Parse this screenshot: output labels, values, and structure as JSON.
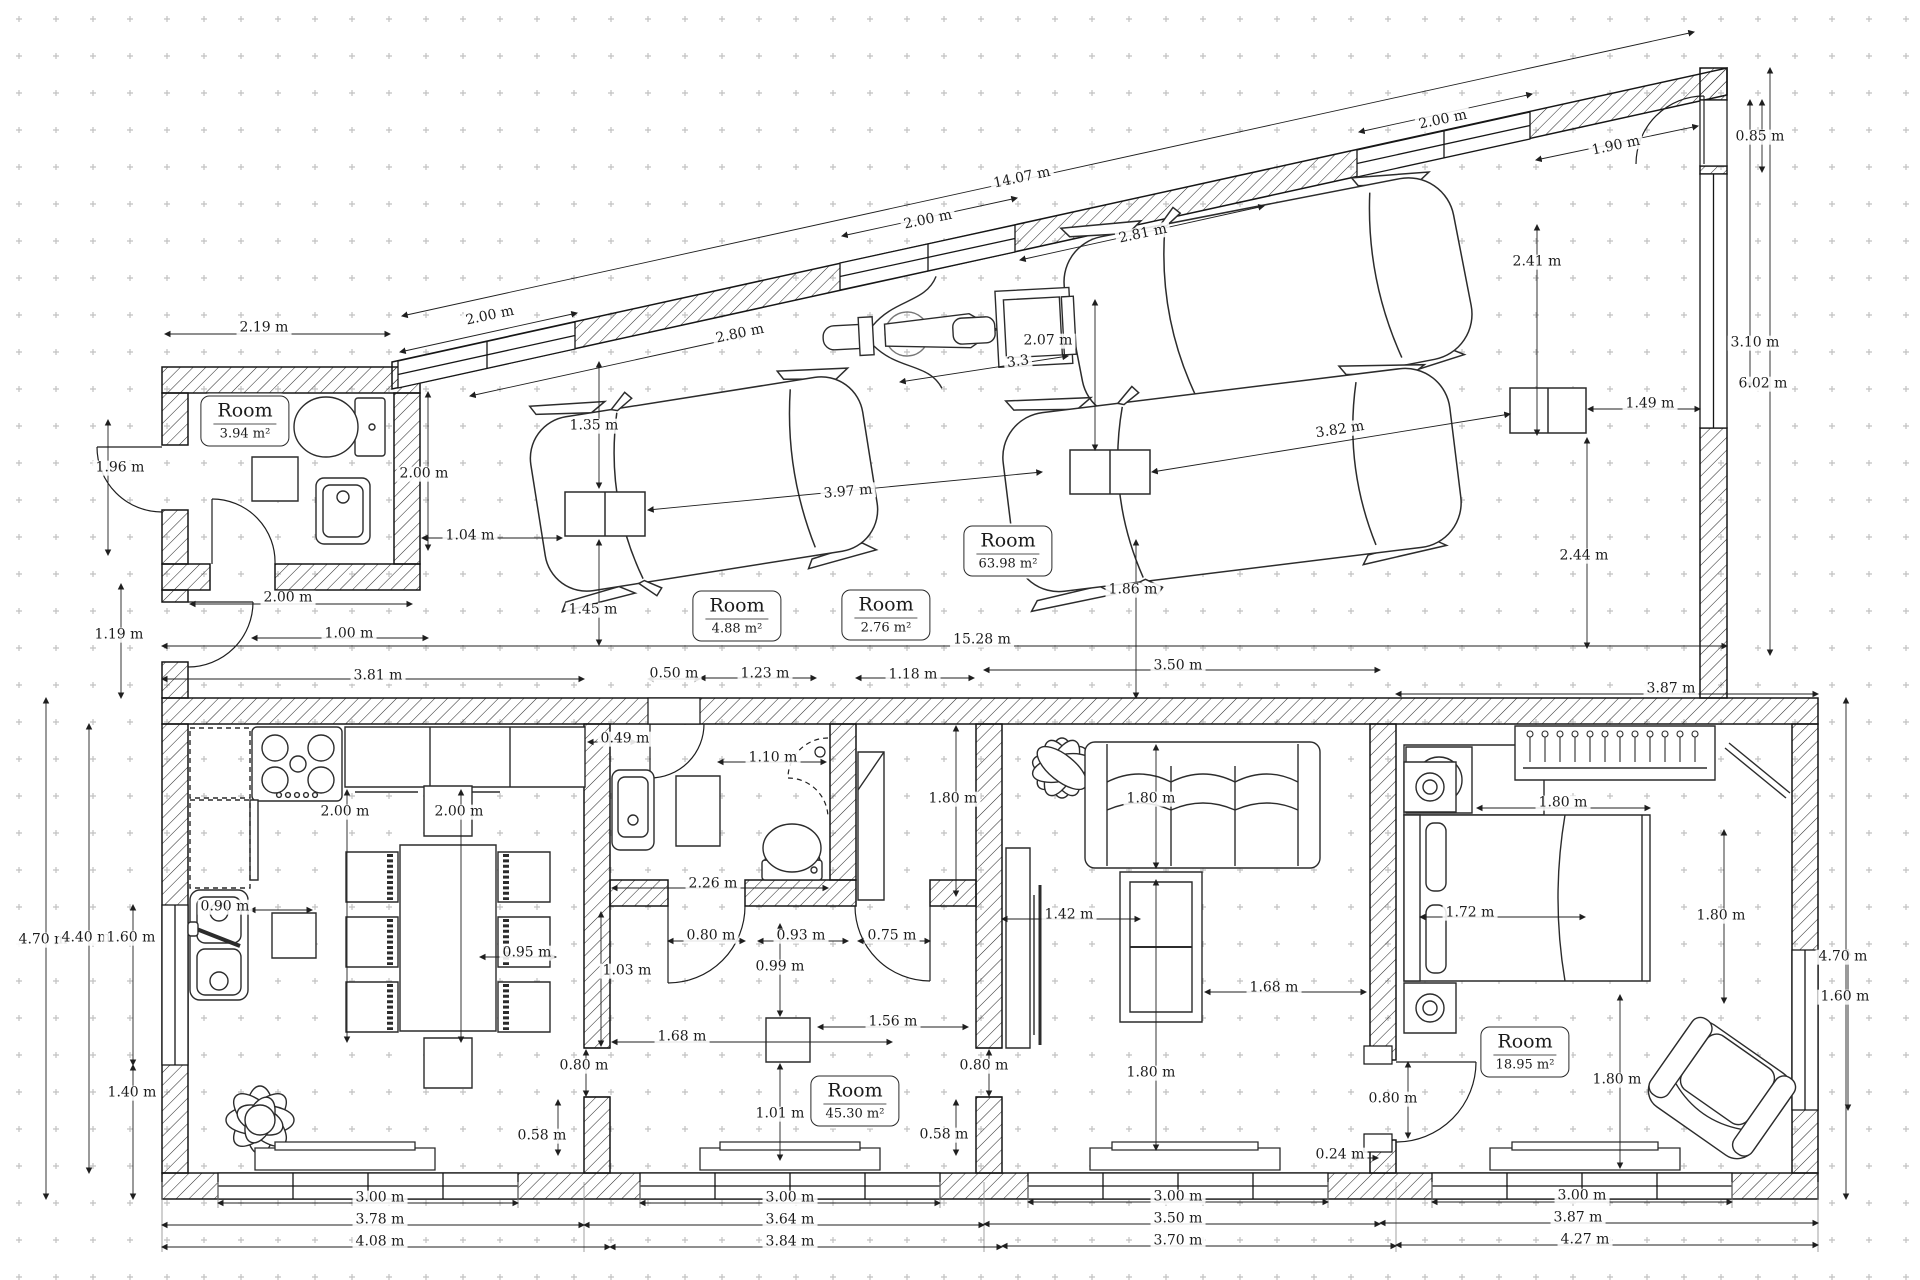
{
  "colors": {
    "ink": "#1f1f1f",
    "paper": "#ffffff",
    "grid_dot": "#c2c2c2",
    "hatch": "#2b2b2b"
  },
  "rooms": [
    {
      "name": "Room",
      "area": "3.94 m²",
      "x": 245,
      "y": 421
    },
    {
      "name": "Room",
      "area": "63.98 m²",
      "x": 1008,
      "y": 551
    },
    {
      "name": "Room",
      "area": "4.88 m²",
      "x": 737,
      "y": 616
    },
    {
      "name": "Room",
      "area": "2.76 m²",
      "x": 886,
      "y": 615
    },
    {
      "name": "Room",
      "area": "45.30 m²",
      "x": 855,
      "y": 1101
    },
    {
      "name": "Room",
      "area": "18.95 m²",
      "x": 1525,
      "y": 1052
    }
  ],
  "dimensions": [
    {
      "t": "2.19 m",
      "x": 264,
      "y": 328
    },
    {
      "t": "2.00 m",
      "x": 490,
      "y": 316,
      "r": -12
    },
    {
      "t": "2.80 m",
      "x": 740,
      "y": 334,
      "r": -12
    },
    {
      "t": "2.00 m",
      "x": 928,
      "y": 220,
      "r": -12
    },
    {
      "t": "14.07 m",
      "x": 1022,
      "y": 178,
      "r": -12
    },
    {
      "t": "2.81 m",
      "x": 1143,
      "y": 234,
      "r": -12
    },
    {
      "t": "2.00 m",
      "x": 1443,
      "y": 120,
      "r": -12
    },
    {
      "t": "1.90 m",
      "x": 1616,
      "y": 146,
      "r": -12
    },
    {
      "t": "0.85 m",
      "x": 1760,
      "y": 137
    },
    {
      "t": "3.10 m",
      "x": 1755,
      "y": 343
    },
    {
      "t": "6.02 m",
      "x": 1763,
      "y": 384
    },
    {
      "t": "2.07 m",
      "x": 1048,
      "y": 341
    },
    {
      "t": "3.3",
      "x": 1018,
      "y": 362,
      "r": -8
    },
    {
      "t": "1.96 m",
      "x": 120,
      "y": 468
    },
    {
      "t": "2.00 m",
      "x": 424,
      "y": 474
    },
    {
      "t": "1.35 m",
      "x": 594,
      "y": 426
    },
    {
      "t": "1.04 m",
      "x": 470,
      "y": 536
    },
    {
      "t": "2.00 m",
      "x": 288,
      "y": 598
    },
    {
      "t": "1.19 m",
      "x": 119,
      "y": 635
    },
    {
      "t": "1.00 m",
      "x": 349,
      "y": 634
    },
    {
      "t": "1.45 m",
      "x": 593,
      "y": 610
    },
    {
      "t": "3.97 m",
      "x": 848,
      "y": 492,
      "r": -5
    },
    {
      "t": "3.82 m",
      "x": 1340,
      "y": 430,
      "r": -9
    },
    {
      "t": "1.49 m",
      "x": 1650,
      "y": 404
    },
    {
      "t": "2.41 m",
      "x": 1537,
      "y": 262
    },
    {
      "t": "2.44 m",
      "x": 1584,
      "y": 556
    },
    {
      "t": "15.28 m",
      "x": 982,
      "y": 640
    },
    {
      "t": "1.86 m",
      "x": 1133,
      "y": 590
    },
    {
      "t": "3.81 m",
      "x": 378,
      "y": 676
    },
    {
      "t": "0.50 m",
      "x": 674,
      "y": 674
    },
    {
      "t": "1.23 m",
      "x": 765,
      "y": 674
    },
    {
      "t": "1.18 m",
      "x": 913,
      "y": 675
    },
    {
      "t": "3.50 m",
      "x": 1178,
      "y": 666
    },
    {
      "t": "3.87 m",
      "x": 1671,
      "y": 689
    },
    {
      "t": "0.49 m",
      "x": 625,
      "y": 739
    },
    {
      "t": "1.10 m",
      "x": 773,
      "y": 758
    },
    {
      "t": "1.80 m",
      "x": 953,
      "y": 799
    },
    {
      "t": "1.80 m",
      "x": 1151,
      "y": 799
    },
    {
      "t": "1.80 m",
      "x": 1563,
      "y": 803
    },
    {
      "t": "2.00 m",
      "x": 345,
      "y": 812
    },
    {
      "t": "2.00 m",
      "x": 459,
      "y": 812
    },
    {
      "t": "0.90 m",
      "x": 225,
      "y": 907
    },
    {
      "t": "1.42 m",
      "x": 1069,
      "y": 915
    },
    {
      "t": "1.72 m",
      "x": 1470,
      "y": 913
    },
    {
      "t": "1.80 m",
      "x": 1721,
      "y": 916
    },
    {
      "t": "4.70 m",
      "x": 43,
      "y": 940
    },
    {
      "t": "4.40 m",
      "x": 86,
      "y": 938
    },
    {
      "t": "1.60 m",
      "x": 131,
      "y": 938
    },
    {
      "t": "0.95 m",
      "x": 527,
      "y": 953
    },
    {
      "t": "1.03 m",
      "x": 627,
      "y": 971
    },
    {
      "t": "0.80 m",
      "x": 711,
      "y": 936
    },
    {
      "t": "0.93 m",
      "x": 801,
      "y": 936
    },
    {
      "t": "0.75 m",
      "x": 892,
      "y": 936
    },
    {
      "t": "0.99 m",
      "x": 780,
      "y": 967
    },
    {
      "t": "2.26 m",
      "x": 713,
      "y": 884
    },
    {
      "t": "1.68 m",
      "x": 682,
      "y": 1037
    },
    {
      "t": "1.56 m",
      "x": 893,
      "y": 1022
    },
    {
      "t": "0.80 m",
      "x": 584,
      "y": 1066
    },
    {
      "t": "0.80 m",
      "x": 984,
      "y": 1066
    },
    {
      "t": "0.58 m",
      "x": 542,
      "y": 1136
    },
    {
      "t": "0.58 m",
      "x": 944,
      "y": 1135
    },
    {
      "t": "1.01 m",
      "x": 780,
      "y": 1114
    },
    {
      "t": "1.40 m",
      "x": 132,
      "y": 1093
    },
    {
      "t": "1.68 m",
      "x": 1274,
      "y": 988
    },
    {
      "t": "1.80 m",
      "x": 1151,
      "y": 1073
    },
    {
      "t": "1.80 m",
      "x": 1617,
      "y": 1080
    },
    {
      "t": "0.80 m",
      "x": 1393,
      "y": 1099
    },
    {
      "t": "0.24 m",
      "x": 1340,
      "y": 1155
    },
    {
      "t": "4.70 m",
      "x": 1843,
      "y": 957
    },
    {
      "t": "1.60 m",
      "x": 1845,
      "y": 997
    },
    {
      "t": "3.00 m",
      "x": 380,
      "y": 1198
    },
    {
      "t": "3.78 m",
      "x": 380,
      "y": 1220
    },
    {
      "t": "4.08 m",
      "x": 380,
      "y": 1242
    },
    {
      "t": "3.00 m",
      "x": 790,
      "y": 1198
    },
    {
      "t": "3.64 m",
      "x": 790,
      "y": 1220
    },
    {
      "t": "3.84 m",
      "x": 790,
      "y": 1242
    },
    {
      "t": "3.00 m",
      "x": 1178,
      "y": 1197
    },
    {
      "t": "3.50 m",
      "x": 1178,
      "y": 1219
    },
    {
      "t": "3.70 m",
      "x": 1178,
      "y": 1241
    },
    {
      "t": "3.00 m",
      "x": 1582,
      "y": 1196
    },
    {
      "t": "3.87 m",
      "x": 1578,
      "y": 1218
    },
    {
      "t": "4.27 m",
      "x": 1585,
      "y": 1240
    }
  ]
}
